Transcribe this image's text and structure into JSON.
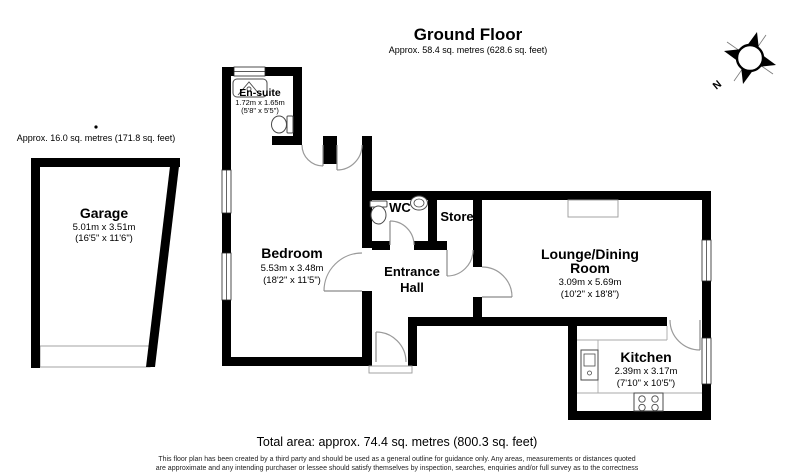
{
  "header": {
    "title": "Ground Floor",
    "subtitle": "Approx. 58.4 sq. metres (628.6 sq. feet)"
  },
  "garage": {
    "annotation": "Approx. 16.0 sq. metres (171.8 sq. feet)",
    "name": "Garage",
    "dim_metric": "5.01m x 3.51m",
    "dim_imperial": "(16'5\" x 11'6\")"
  },
  "rooms": {
    "ensuite": {
      "name": "En-suite",
      "dim_metric": "1.72m x 1.65m",
      "dim_imperial": "(5'8\" x 5'5\")"
    },
    "bedroom": {
      "name": "Bedroom",
      "dim_metric": "5.53m x 3.48m",
      "dim_imperial": "(18'2\" x 11'5\")"
    },
    "wc": {
      "name": "WC"
    },
    "store": {
      "name": "Store"
    },
    "entrance_hall": {
      "name_line1": "Entrance",
      "name_line2": "Hall"
    },
    "lounge": {
      "name_line1": "Lounge/Dining",
      "name_line2": "Room",
      "dim_metric": "3.09m x 5.69m",
      "dim_imperial": "(10'2\" x 18'8\")"
    },
    "kitchen": {
      "name": "Kitchen",
      "dim_metric": "2.39m x 3.17m",
      "dim_imperial": "(7'10\" x 10'5\")"
    }
  },
  "compass": {
    "north_label": "N"
  },
  "footer": {
    "total_area": "Total area: approx. 74.4 sq. metres (800.3 sq. feet)",
    "disclaimer_line1": "This floor plan has been created by a third party and should be used as a general outline for guidance only. Any areas, measurements or distances quoted",
    "disclaimer_line2": "are approximate and any intending purchaser or lessee should satisfy themselves by inspection, searches, enquiries and/or full survey as to the correctness"
  },
  "colors": {
    "wall": "#000000",
    "door_arc": "#9a9a9a",
    "window_frame": "#222222",
    "fixture": "#4a4a4a",
    "text": "#000000"
  }
}
